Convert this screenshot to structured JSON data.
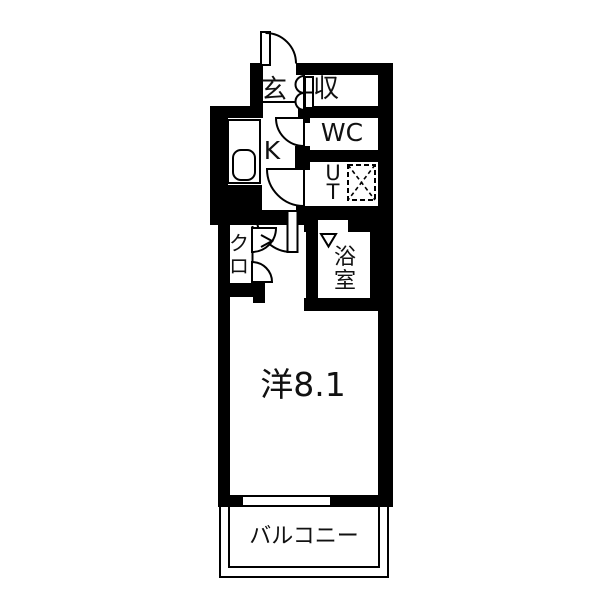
{
  "title": "apartment-floor-plan",
  "colors": {
    "background": "#ffffff",
    "wall": "#000000",
    "line": "#000000",
    "text": "#111111"
  },
  "rooms": {
    "entrance": {
      "label": "玄"
    },
    "storage": {
      "label": "収"
    },
    "wc": {
      "label": "WC"
    },
    "kitchen": {
      "label": "K"
    },
    "utility": {
      "label": "UT"
    },
    "bathroom": {
      "label": "浴室"
    },
    "closet": {
      "label": "クロ"
    },
    "main_room": {
      "label": "洋8.1"
    },
    "balcony": {
      "label": "バルコニー"
    }
  }
}
